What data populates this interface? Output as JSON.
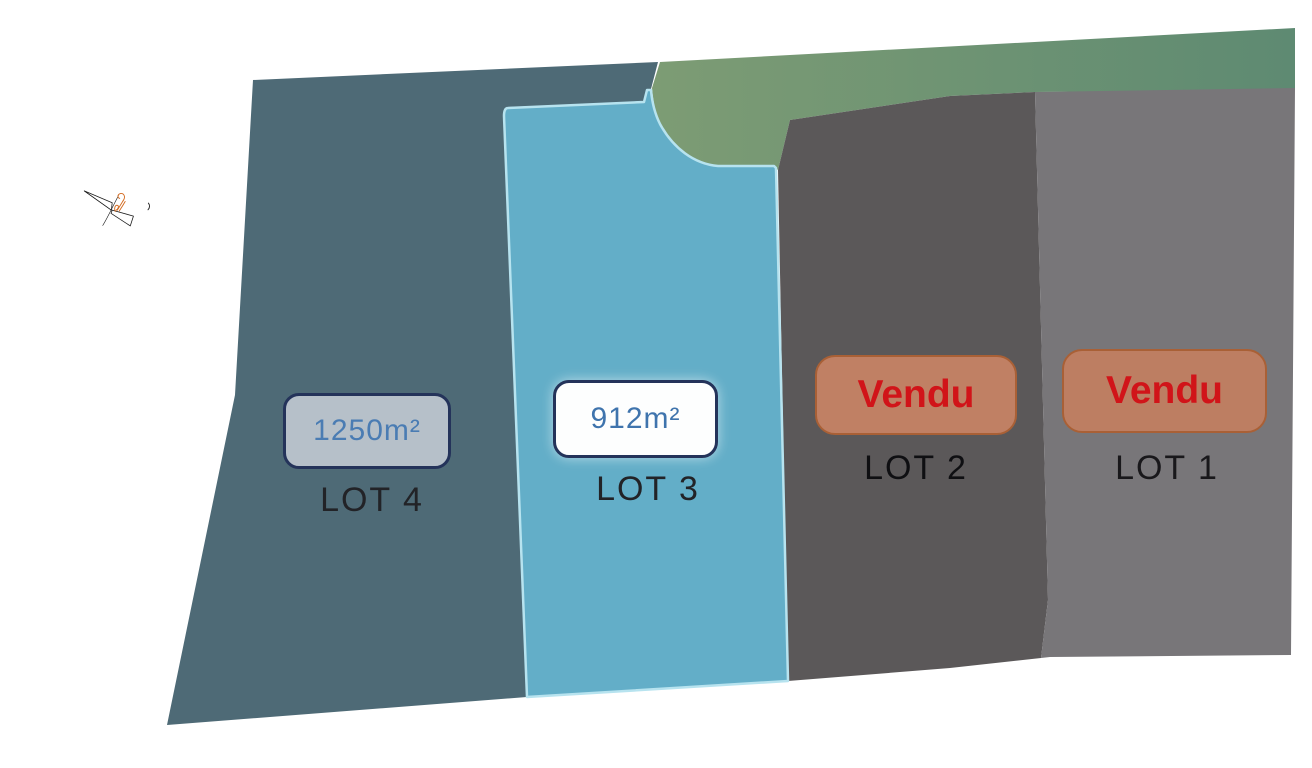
{
  "map": {
    "description_label": "Plan de lotissement",
    "lots": [
      {
        "id": "lot-1",
        "label": "LOT 1",
        "badge": "Vendu",
        "status": "sold",
        "fill": "#787679"
      },
      {
        "id": "lot-2",
        "label": "LOT 2",
        "badge": "Vendu",
        "status": "sold",
        "fill": "#5b5859"
      },
      {
        "id": "lot-3",
        "label": "LOT 3",
        "badge": "912m²",
        "status": "available",
        "fill": "#63aec8",
        "stroke": "#b7e3ef"
      },
      {
        "id": "lot-4",
        "label": "LOT 4",
        "badge": "1250m²",
        "status": "available",
        "fill": "#4e6a76"
      }
    ],
    "greenbelt": {
      "fill_left": "#7d9c74",
      "fill_right": "#5e8a72"
    },
    "colors": {
      "background": "#ffffff",
      "sold_badge_bg": "#c08064",
      "sold_badge_border": "#a96036",
      "sold_badge_text": "#d11419",
      "available_badge_border": "#24335a",
      "available_badge_text_blue": "#4a7cb3",
      "size_badge_lot4_bg": "#b6c0c9",
      "size_badge_lot3_bg": "#fdfefe",
      "lot_label_text": "#222327",
      "compass_ink": "#1c1c1c",
      "compass_accent_orange": "#d2691e"
    }
  }
}
